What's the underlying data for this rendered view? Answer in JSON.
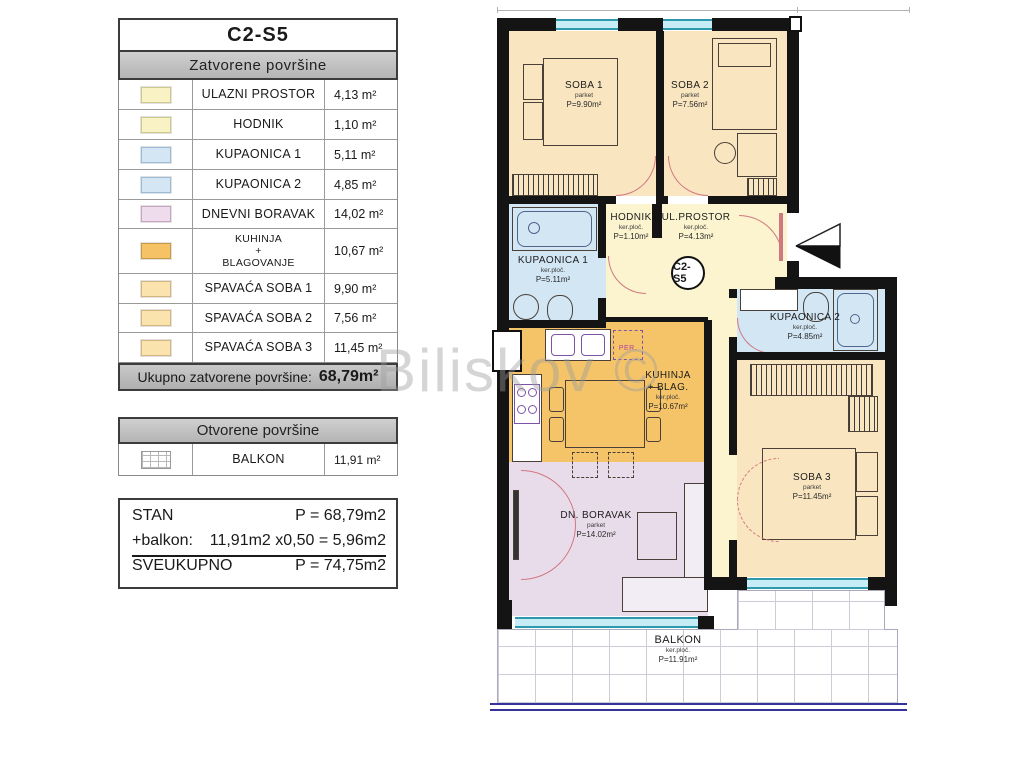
{
  "legend": {
    "title": "C2-S5",
    "closed_header": "Zatvorene površine",
    "rows": [
      {
        "name": "ULAZNI PROSTOR",
        "value": "4,13 m²",
        "color": "#f8f2c4"
      },
      {
        "name": "HODNIK",
        "value": "1,10 m²",
        "color": "#f8f2c4"
      },
      {
        "name": "KUPAONICA 1",
        "value": "5,11 m²",
        "color": "#d4e6f4"
      },
      {
        "name": "KUPAONICA 2",
        "value": "4,85 m²",
        "color": "#d4e6f4"
      },
      {
        "name": "DNEVNI BORAVAK",
        "value": "14,02 m²",
        "color": "#eedcec"
      },
      {
        "name_lines": [
          "KUHINJA",
          "+",
          "BLAGOVANJE"
        ],
        "value": "10,67 m²",
        "color": "#f5c366"
      },
      {
        "name": "SPAVAĆA SOBA 1",
        "value": "9,90 m²",
        "color": "#fbe3ae"
      },
      {
        "name": "SPAVAĆA SOBA 2",
        "value": "7,56 m²",
        "color": "#fbe3ae"
      },
      {
        "name": "SPAVAĆA SOBA 3",
        "value": "11,45 m²",
        "color": "#fbe3ae"
      }
    ],
    "total_label": "Ukupno zatvorene površine:",
    "total_value": "68,79m²",
    "open_header": "Otvorene površine",
    "open_row": {
      "name": "BALKON",
      "value": "11,91 m²"
    },
    "summary": {
      "line1_label": "STAN",
      "line1_value": "P = 68,79m2",
      "line2_label": "+balkon:",
      "line2_value": "11,91m2 x0,50 =  5,96m2",
      "line3_label": "SVEUKUPNO",
      "line3_value": "P = 74,75m2"
    }
  },
  "plan": {
    "badge": "C2-S5",
    "washer_label": "PER.",
    "rooms": [
      {
        "name": "SOBA 1",
        "floor": "parket",
        "area": "P=9.90m²"
      },
      {
        "name": "SOBA 2",
        "floor": "parket",
        "area": "P=7.56m²"
      },
      {
        "name": "HODNIK",
        "floor": "ker.ploč.",
        "area": "P=1.10m²"
      },
      {
        "name": "UL.PROSTOR",
        "floor": "ker.ploč.",
        "area": "P=4.13m²"
      },
      {
        "name": "KUPAONICA 1",
        "floor": "ker.ploč.",
        "area": "P=5.11m²"
      },
      {
        "name": "KUPAONICA 2",
        "floor": "ker.ploč.",
        "area": "P=4.85m²"
      },
      {
        "name": "KUHINJA",
        "name2": "+ BLAG.",
        "floor": "ker.ploč.",
        "area": "P=10.67m²"
      },
      {
        "name": "DN. BORAVAK",
        "floor": "parket",
        "area": "P=14.02m²"
      },
      {
        "name": "SOBA 3",
        "floor": "parket",
        "area": "P=11.45m²"
      },
      {
        "name": "BALKON",
        "floor": "ker.ploč.",
        "area": "P=11.91m²"
      }
    ]
  },
  "watermark": "Biliskov ©",
  "colors": {
    "wall": "#141414",
    "wheat": "#f9e6c0",
    "pale_yellow": "#fcf4cf",
    "pale_blue": "#d2e6f4",
    "orange": "#f5c469",
    "lavender": "#e9dcea",
    "window": "#c6ecf5",
    "window_line": "#2e98ac",
    "door_swing": "#d07880",
    "balcony_grid": "#ccccd8",
    "railing": "#33339a",
    "header_gray": "#c4c4c4"
  }
}
